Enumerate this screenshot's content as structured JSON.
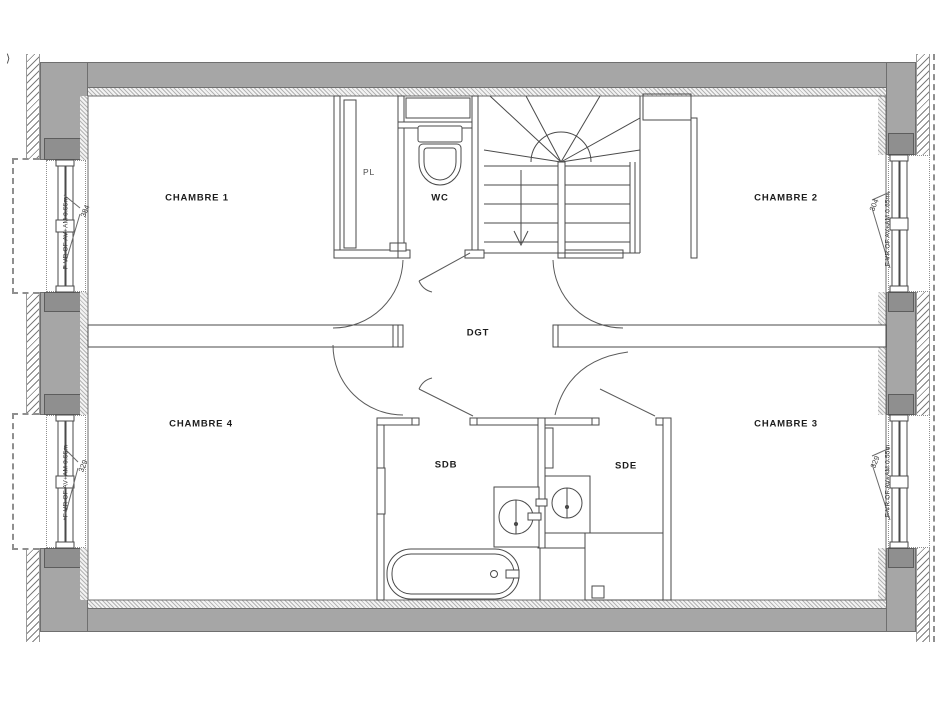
{
  "drawing": {
    "type": "floor-plan",
    "rooms": {
      "chambre1": {
        "label": "CHAMBRE 1"
      },
      "chambre2": {
        "label": "CHAMBRE 2"
      },
      "chambre3": {
        "label": "CHAMBRE 3"
      },
      "chambre4": {
        "label": "CHAMBRE 4"
      },
      "pl": {
        "label": "PL"
      },
      "wc": {
        "label": "WC"
      },
      "dgt": {
        "label": "DGT"
      },
      "sdb": {
        "label": "SDB"
      },
      "sde": {
        "label": "SDE"
      }
    },
    "windows": {
      "top_left": {
        "label": "F VR OF AV+AM 0.55m",
        "dimension": "384"
      },
      "top_right": {
        "label": "F VR OF AV+AM 0.65m",
        "dimension": "304"
      },
      "bottom_left": {
        "label": "F VR OF AV+AM 0.55m",
        "dimension": "329"
      },
      "bottom_right": {
        "label": "F VR OF AV+AM 0.55m",
        "dimension": "329"
      }
    },
    "marks": {
      "top_left_mark": "⟩"
    },
    "colors": {
      "wall_fill": "#a6a6a6",
      "line": "#3f3f3f",
      "background": "#ffffff"
    }
  }
}
